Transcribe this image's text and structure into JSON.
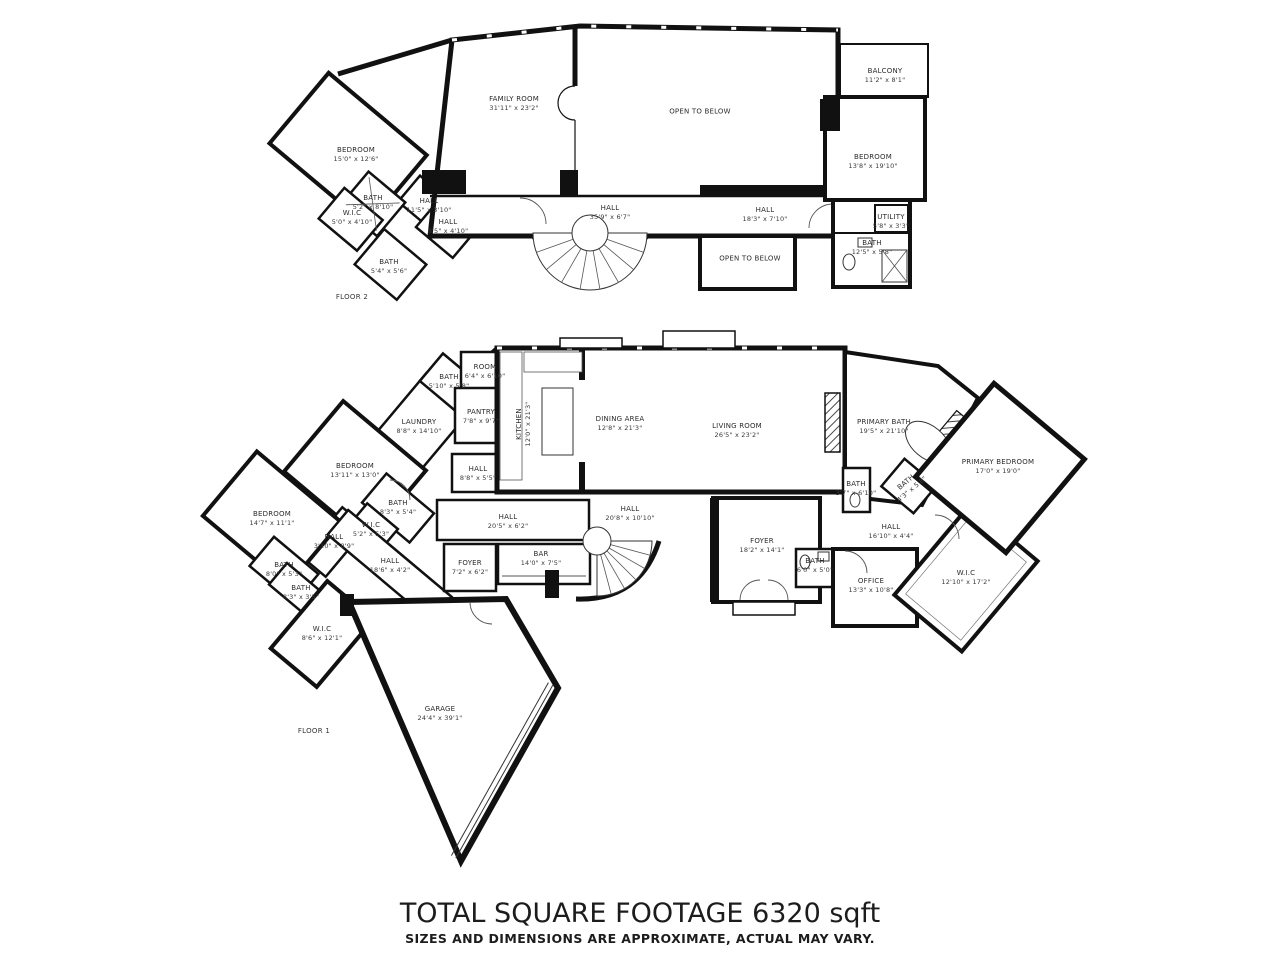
{
  "footer": {
    "title": "TOTAL SQUARE FOOTAGE 6320 sqft",
    "disclaimer": "SIZES AND DIMENSIONS ARE APPROXIMATE, ACTUAL MAY VARY."
  },
  "floors": [
    {
      "label": "FLOOR 2",
      "rooms": [
        {
          "name": "FAMILY ROOM",
          "dims": "31'11\" x 23'2\"",
          "x": 514,
          "y": 104
        },
        {
          "name": "OPEN TO BELOW",
          "dims": "",
          "x": 700,
          "y": 112
        },
        {
          "name": "BALCONY",
          "dims": "11'2\" x 8'1\"",
          "x": 885,
          "y": 76
        },
        {
          "name": "BEDROOM",
          "dims": "13'8\" x 19'10\"",
          "x": 873,
          "y": 162
        },
        {
          "name": "BEDROOM",
          "dims": "15'0\" x 12'6\"",
          "x": 356,
          "y": 155
        },
        {
          "name": "BATH",
          "dims": "5'2\" x 8'10\"",
          "x": 373,
          "y": 203
        },
        {
          "name": "W.I.C",
          "dims": "5'0\" x 4'10\"",
          "x": 352,
          "y": 218
        },
        {
          "name": "HALL",
          "dims": "11'5\" x 3'10\"",
          "x": 429,
          "y": 206
        },
        {
          "name": "HALL",
          "dims": "8'5\" x 4'10\"",
          "x": 448,
          "y": 227
        },
        {
          "name": "BATH",
          "dims": "5'4\" x 5'6\"",
          "x": 389,
          "y": 267
        },
        {
          "name": "HALL",
          "dims": "35'9\" x 6'7\"",
          "x": 610,
          "y": 213
        },
        {
          "name": "HALL",
          "dims": "18'3\" x 7'10\"",
          "x": 765,
          "y": 215
        },
        {
          "name": "UTILITY",
          "dims": "5'8\" x 3'3\"",
          "x": 891,
          "y": 222
        },
        {
          "name": "BATH",
          "dims": "12'5\" x 5'8\"",
          "x": 872,
          "y": 248
        },
        {
          "name": "OPEN TO BELOW",
          "dims": "",
          "x": 750,
          "y": 259
        }
      ],
      "caption_pos": {
        "x": 352,
        "y": 297
      }
    },
    {
      "label": "FLOOR 1",
      "rooms": [
        {
          "name": "ROOM",
          "dims": "6'4\" x 6'10\"",
          "x": 485,
          "y": 372
        },
        {
          "name": "BATH",
          "dims": "5'10\" x 5'8\"",
          "x": 449,
          "y": 382
        },
        {
          "name": "PANTRY",
          "dims": "7'8\" x 9'7\"",
          "x": 481,
          "y": 417
        },
        {
          "name": "LAUNDRY",
          "dims": "8'8\" x 14'10\"",
          "x": 419,
          "y": 427
        },
        {
          "name": "KITCHEN",
          "dims": "12'0\" x 21'3\"",
          "x": 524,
          "y": 424,
          "rot": -90
        },
        {
          "name": "DINING AREA",
          "dims": "12'8\" x 21'3\"",
          "x": 620,
          "y": 424
        },
        {
          "name": "LIVING ROOM",
          "dims": "26'5\" x 23'2\"",
          "x": 737,
          "y": 431
        },
        {
          "name": "PRIMARY BATH",
          "dims": "19'5\" x 21'10\"",
          "x": 884,
          "y": 427
        },
        {
          "name": "PRIMARY BEDROOM",
          "dims": "17'0\" x 19'0\"",
          "x": 998,
          "y": 467
        },
        {
          "name": "BEDROOM",
          "dims": "13'11\" x 13'0\"",
          "x": 355,
          "y": 471
        },
        {
          "name": "HALL",
          "dims": "8'8\" x 5'5\"",
          "x": 478,
          "y": 474
        },
        {
          "name": "BATH",
          "dims": "8'3\" x 5'4\"",
          "x": 398,
          "y": 508
        },
        {
          "name": "W.I.C",
          "dims": "5'2\" x 5'3\"",
          "x": 371,
          "y": 530
        },
        {
          "name": "HALL",
          "dims": "3'10\" x 8'9\"",
          "x": 334,
          "y": 542
        },
        {
          "name": "BEDROOM",
          "dims": "14'7\" x 11'1\"",
          "x": 272,
          "y": 519
        },
        {
          "name": "HALL",
          "dims": "20'5\" x 6'2\"",
          "x": 508,
          "y": 522
        },
        {
          "name": "HALL",
          "dims": "20'8\" x 10'10\"",
          "x": 630,
          "y": 514
        },
        {
          "name": "BATH",
          "dims": "3'7\" x 6'10\"",
          "x": 856,
          "y": 489
        },
        {
          "name": "BATH",
          "dims": "4'3\" x 5'8\"",
          "x": 909,
          "y": 486,
          "rot": -40
        },
        {
          "name": "HALL",
          "dims": "16'10\" x 4'4\"",
          "x": 891,
          "y": 532
        },
        {
          "name": "FOYER",
          "dims": "18'2\" x 14'1\"",
          "x": 762,
          "y": 546
        },
        {
          "name": "BATH",
          "dims": "6'0\" x 5'0\"",
          "x": 815,
          "y": 566
        },
        {
          "name": "OFFICE",
          "dims": "13'3\" x 10'8\"",
          "x": 871,
          "y": 586
        },
        {
          "name": "W.I.C",
          "dims": "12'10\" x 17'2\"",
          "x": 966,
          "y": 578
        },
        {
          "name": "BATH",
          "dims": "8'0\" x 5'3\"",
          "x": 284,
          "y": 570
        },
        {
          "name": "BATH",
          "dims": "8'3\" x 3'5\"",
          "x": 301,
          "y": 593
        },
        {
          "name": "W.I.C",
          "dims": "8'6\" x 12'1\"",
          "x": 322,
          "y": 634
        },
        {
          "name": "HALL",
          "dims": "18'6\" x 4'2\"",
          "x": 390,
          "y": 566
        },
        {
          "name": "FOYER",
          "dims": "7'2\" x 6'2\"",
          "x": 470,
          "y": 568
        },
        {
          "name": "BAR",
          "dims": "14'0\" x 7'5\"",
          "x": 541,
          "y": 559
        },
        {
          "name": "GARAGE",
          "dims": "24'4\" x 39'1\"",
          "x": 440,
          "y": 714
        }
      ],
      "caption_pos": {
        "x": 314,
        "y": 731
      }
    }
  ]
}
